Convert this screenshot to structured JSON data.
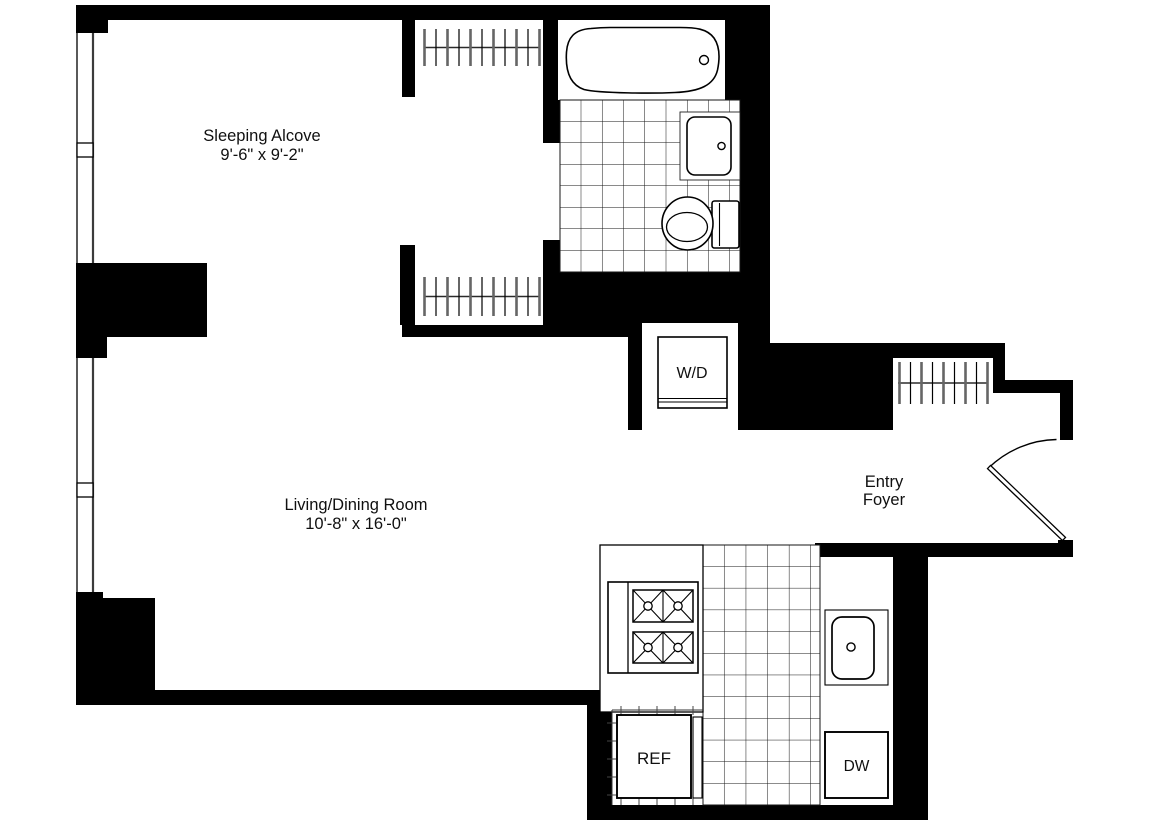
{
  "rooms": {
    "sleeping_alcove": {
      "name": "Sleeping Alcove",
      "dimensions": "9'-6\" x 9'-2\""
    },
    "living_dining": {
      "name": "Living/Dining Room",
      "dimensions": "10'-8\" x 16'-0\""
    },
    "entry_foyer": {
      "name_line1": "Entry",
      "name_line2": "Foyer"
    }
  },
  "appliances": {
    "washer_dryer": "W/D",
    "refrigerator": "REF",
    "dishwasher": "DW"
  },
  "colors": {
    "wall": "#000000",
    "background": "#ffffff",
    "line": "#1a1a1a"
  }
}
